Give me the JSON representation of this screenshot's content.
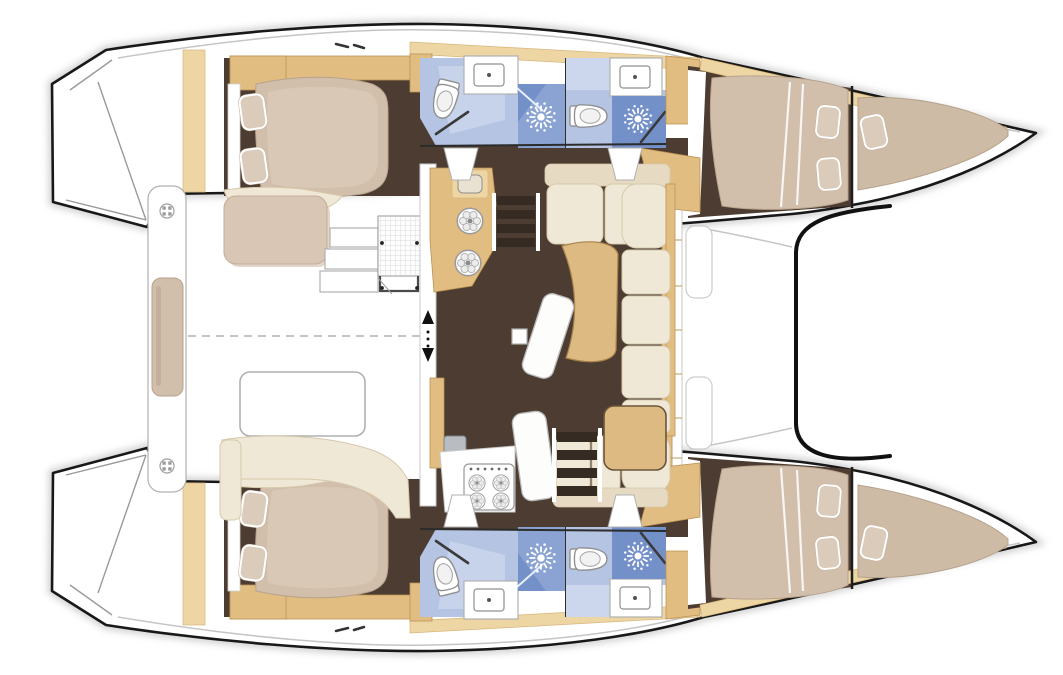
{
  "meta": {
    "description": "Top-down interior layout floor plan of a sailing catamaran, bow to the right, no visible text labels",
    "canvas": {
      "width": 1063,
      "height": 675
    }
  },
  "colors": {
    "background": "#ffffff",
    "outline": "#181818",
    "line_grey": "#9b9b9b",
    "floor_brown": "#4c3c31",
    "step_dark": "#362b23",
    "wood": "#e2bd82",
    "wood_light": "#edd6a4",
    "table_wood": "#dcba82",
    "wood_edge": "#bb9354",
    "mattress": "#d2bfab",
    "mattress_edge": "#b7a28c",
    "pillow": "#dbcbbb",
    "cream": "#f0e8d6",
    "cream_dark": "#e6dac3",
    "cream_edge": "#d6c8ab",
    "bath_floor": "#b5c4e2",
    "bath_light": "#ccd7ee",
    "shower_mid": "#8aa3d3",
    "shower_dark": "#7390c9",
    "fixture_stroke": "#8f8f8f",
    "shadow": "#c9c9c9",
    "dash": "#c3c3c3"
  },
  "diagram": {
    "type": "floorplan",
    "subject": "catamaran-yacht-interior-layout",
    "orientation": "bow-right-stern-left",
    "symmetry": "mirrored-about-horizontal-centerline",
    "hulls": [
      {
        "name": "port-hull",
        "position": "top",
        "spaces": [
          {
            "name": "transom-steps",
            "features": [
              "step-lines"
            ]
          },
          {
            "name": "aft-cabin",
            "furniture": [
              "double-berth",
              "pillow",
              "pillow",
              "shelf-unit",
              "bench-seat"
            ]
          },
          {
            "name": "aft-bathroom",
            "fixtures": [
              "toilet",
              "washbasin",
              "shower-compartment",
              "shower-head-symbol",
              "door"
            ]
          },
          {
            "name": "forward-bathroom",
            "fixtures": [
              "toilet",
              "washbasin",
              "shower-compartment",
              "shower-head-symbol",
              "door"
            ]
          },
          {
            "name": "forward-cabin",
            "furniture": [
              "double-berth",
              "pillow",
              "pillow"
            ]
          },
          {
            "name": "forepeak-berth",
            "furniture": [
              "v-berth",
              "pillow"
            ]
          }
        ]
      },
      {
        "name": "starboard-hull",
        "position": "bottom",
        "spaces": [
          {
            "name": "transom-steps",
            "features": [
              "step-lines"
            ]
          },
          {
            "name": "aft-cabin",
            "furniture": [
              "double-berth",
              "pillow",
              "pillow",
              "shelf-unit",
              "bench-seat"
            ]
          },
          {
            "name": "aft-bathroom",
            "fixtures": [
              "toilet",
              "washbasin",
              "shower-compartment",
              "shower-head-symbol",
              "door"
            ]
          },
          {
            "name": "forward-bathroom",
            "fixtures": [
              "toilet",
              "washbasin",
              "shower-compartment",
              "shower-head-symbol",
              "door"
            ]
          },
          {
            "name": "forward-cabin",
            "furniture": [
              "double-berth",
              "pillow",
              "pillow"
            ]
          },
          {
            "name": "forepeak-berth",
            "furniture": [
              "v-berth",
              "pillow"
            ]
          }
        ]
      }
    ],
    "bridgedeck": {
      "cockpit": {
        "position": "aft-between-hulls",
        "furniture": [
          "aft-bench",
          "bench-cushion",
          "deck-fitting",
          "deck-fitting",
          "side-bench-cushion",
          "side-steps",
          "grid-table-unit",
          "cockpit-table",
          "curved-bench"
        ],
        "features": [
          "dashed-centerline"
        ]
      },
      "saloon": {
        "furniture": [
          "c-shaped-sofa",
          "curved-dining-table",
          "second-table",
          "chaise-seat",
          "chaise-seat",
          "galley-counter-round-sinks",
          "galley-appliance",
          "galley-counter-stove",
          "stove-4-burners",
          "oven-unit",
          "companionway-steps-port",
          "companionway-steps-starboard",
          "sliding-door-arrows",
          "cabinet-front-wall"
        ]
      },
      "foredeck": {
        "features": [
          "deck-hatch",
          "deck-hatch",
          "forward-crossbeam",
          "trampoline-area"
        ]
      }
    }
  }
}
